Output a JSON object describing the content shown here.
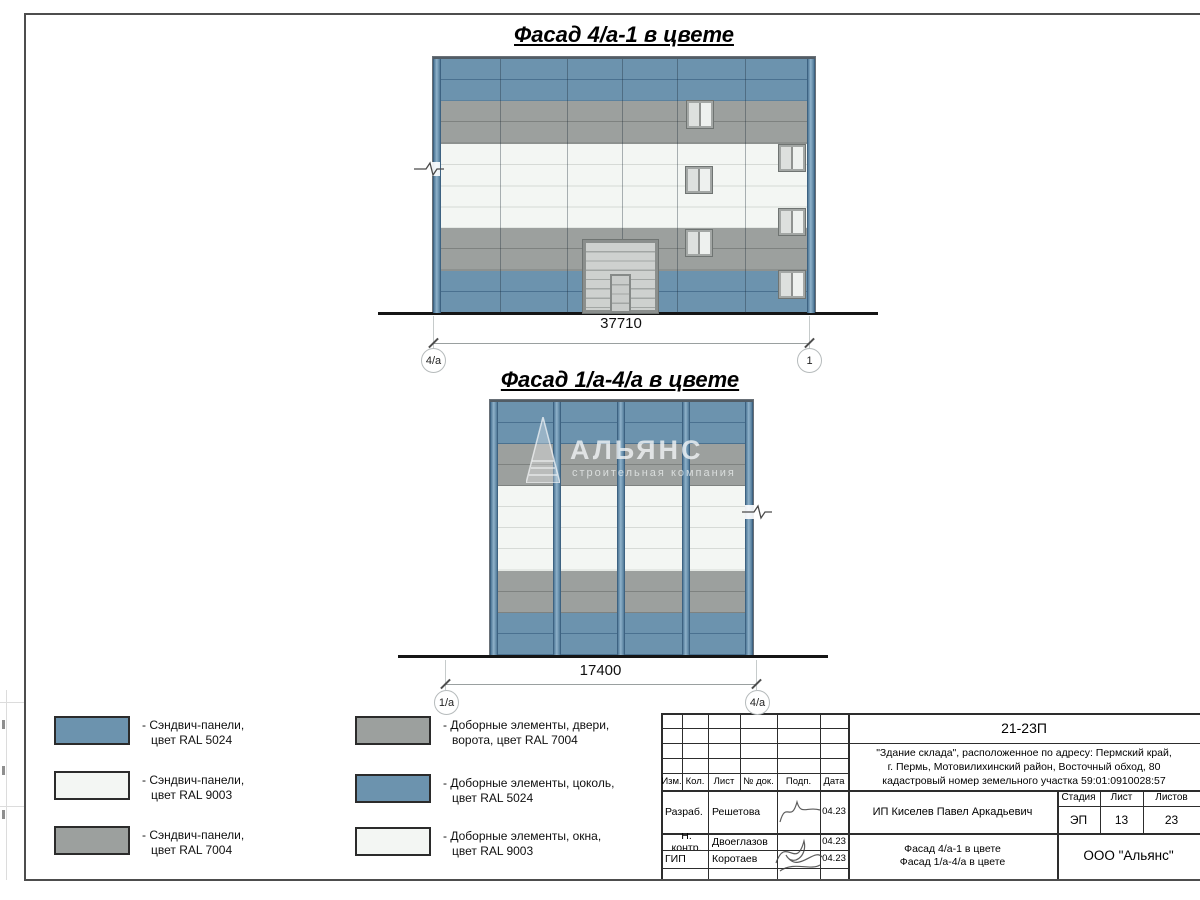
{
  "colors": {
    "ral5024": "#6C93AE",
    "ral7004": "#9CA09E",
    "ral9003": "#F3F6F3",
    "jblue": "#4A7190",
    "jgray": "#7E8280",
    "jwhite": "#D6DAD6"
  },
  "facade1": {
    "title": "Фасад 4/а-1 в цвете",
    "dimension": "37710",
    "axis_left": "4/а",
    "axis_right": "1"
  },
  "facade2": {
    "title": "Фасад 1/а-4/а в цвете",
    "dimension": "17400",
    "axis_left": "1/а",
    "axis_right": "4/а",
    "watermark_title": "АЛЬЯНС",
    "watermark_subtitle": "строительная компания"
  },
  "legend": {
    "items": [
      {
        "line1": "- Сэндвич-панели,",
        "line2": "цвет RAL 5024"
      },
      {
        "line1": "- Сэндвич-панели,",
        "line2": "цвет RAL 9003"
      },
      {
        "line1": "- Сэндвич-панели,",
        "line2": "цвет RAL 7004"
      },
      {
        "line1": "- Доборные элементы, двери,",
        "line2": "ворота, цвет RAL 7004"
      },
      {
        "line1": "- Доборные элементы, цоколь,",
        "line2": "цвет RAL 5024"
      },
      {
        "line1": "- Доборные элементы, окна,",
        "line2": "цвет RAL 9003"
      }
    ]
  },
  "titleblock": {
    "project_code": "21-23П",
    "description_line1": "\"Здание склада\", расположенное по адресу: Пермский край,",
    "description_line2": "г. Пермь, Мотовилихинский район, Восточный обход, 80",
    "description_line3": "кадастровый номер земельного участка 59:01:0910028:57",
    "col_izm": "Изм.",
    "col_kol": "Кол.",
    "col_list": "Лист",
    "col_ndok": "№ док.",
    "col_podp": "Подп.",
    "col_data": "Дата",
    "row1_role": "Разраб.",
    "row1_name": "Решетова",
    "row1_date": "04.23",
    "row2_role": "Н. контр.",
    "row2_name": "Двоеглазов",
    "row2_date": "04.23",
    "row3_role": "ГИП",
    "row3_name": "Коротаев",
    "row3_date": "04.23",
    "client": "ИП Киселев Павел Аркадьевич",
    "stage_label": "Стадия",
    "list_label": "Лист",
    "listov_label": "Листов",
    "stage_value": "ЭП",
    "list_value": "13",
    "listov_value": "23",
    "title_line1": "Фасад 4/а-1 в цвете",
    "title_line2": "Фасад 1/а-4/а в цвете",
    "company": "ООО \"Альянс\""
  }
}
